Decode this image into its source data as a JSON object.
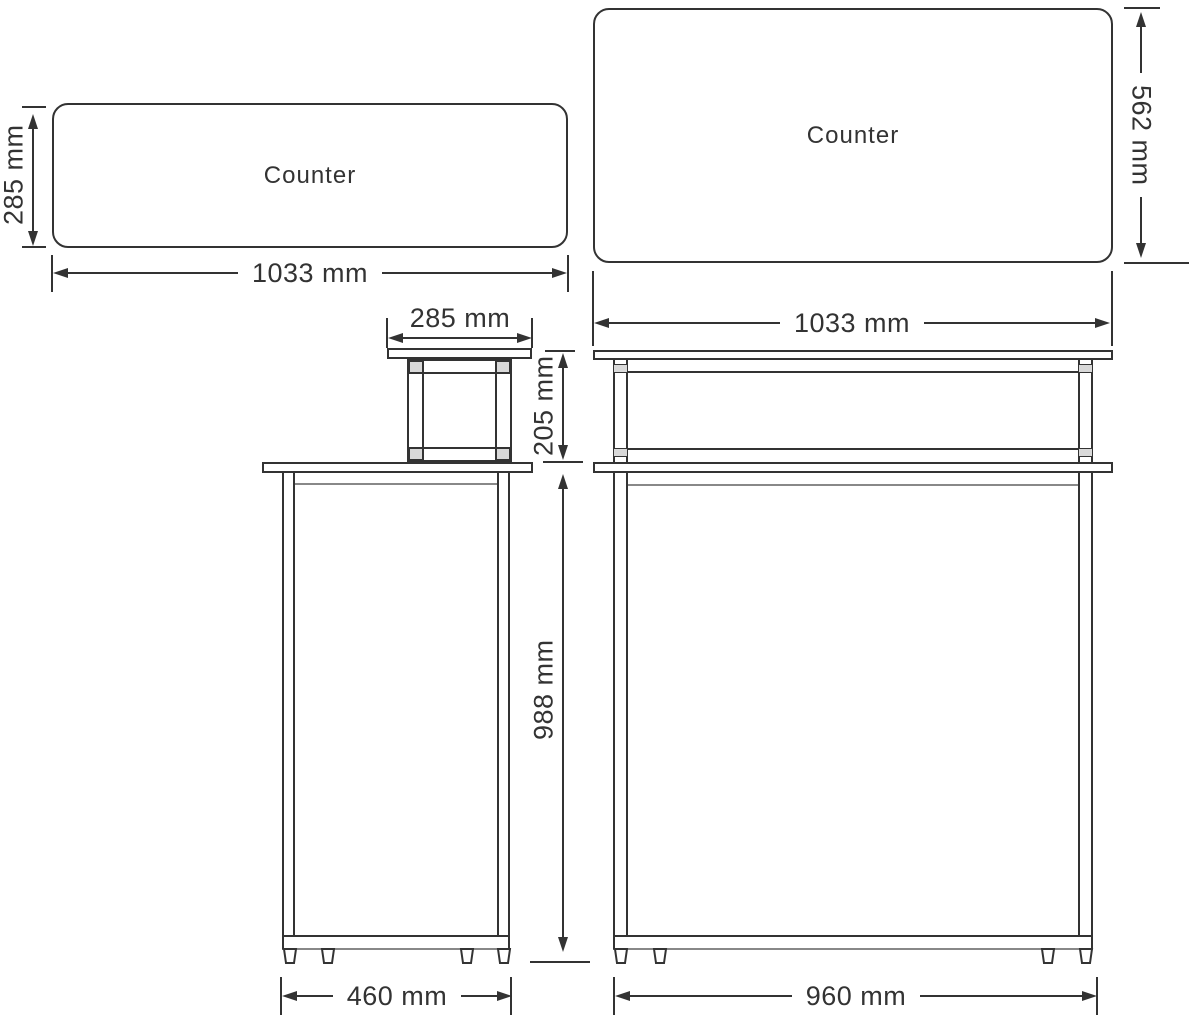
{
  "diagram": {
    "type": "furniture-dimension-drawing",
    "subject": "counter-desk"
  },
  "plan_left": {
    "label": "Counter",
    "width": "1033 mm",
    "depth": "285 mm"
  },
  "plan_right": {
    "label": "Counter",
    "height": "562 mm"
  },
  "side_elevation": {
    "shelf_width": "285 mm",
    "riser_height": "205 mm",
    "under_height": "988 mm",
    "base_depth": "460 mm"
  },
  "front_elevation": {
    "top_width": "1033 mm",
    "base_width": "960 mm"
  },
  "colors": {
    "line": "#333333",
    "line_light": "#888888",
    "connector_fill": "#d9d9d9",
    "text": "#333333",
    "background": "#ffffff"
  }
}
